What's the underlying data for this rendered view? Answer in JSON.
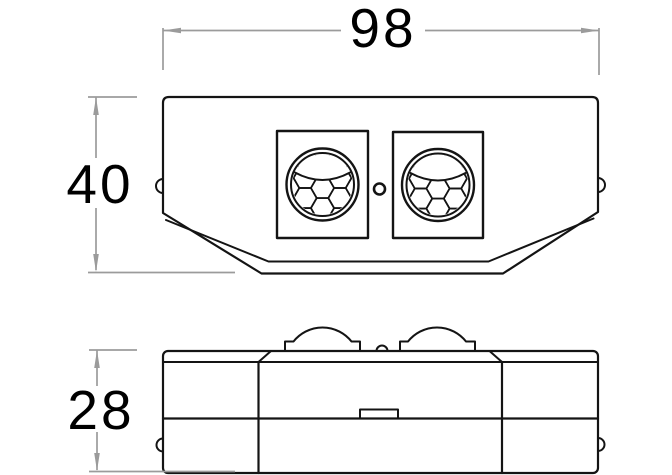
{
  "colors": {
    "ink": "#141414",
    "dimension_lines": "#9b9b9b",
    "background": "#ffffff"
  },
  "front_view": {
    "dimension_width": "98",
    "dimension_height": "40",
    "features": [
      "left-sensor-frame",
      "right-sensor-frame",
      "left-pir-lens",
      "right-pir-lens",
      "led-indicator",
      "side-clip-left",
      "side-clip-right",
      "chamfered-bottom"
    ]
  },
  "side_view": {
    "dimension_depth": "28",
    "features": [
      "left-dome-lens",
      "right-dome-lens",
      "led-bump",
      "cover-parting-line",
      "release-tab",
      "side-clip-left",
      "side-clip-right"
    ]
  }
}
